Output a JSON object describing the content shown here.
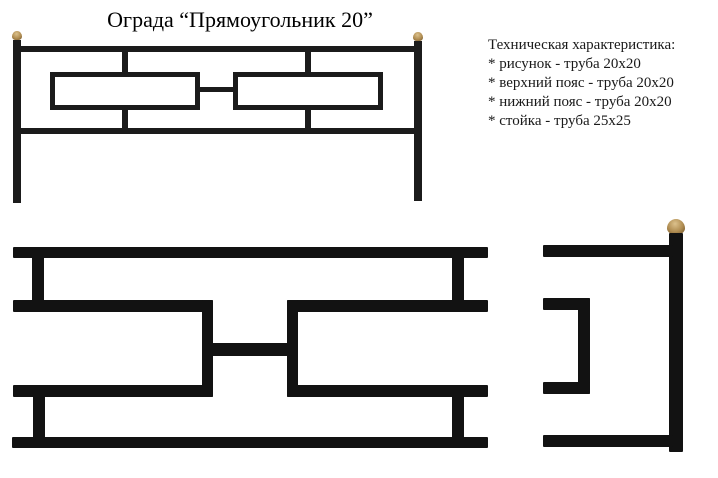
{
  "title": "Ограда “Прямоугольник 20”",
  "specs": {
    "heading": "Техническая характеристика:",
    "items": [
      "* рисунок - труба 20х20",
      "* верхний пояс - труба 20х20",
      "* нижний пояс - труба 20х20",
      "* стойка - труба 25х25"
    ]
  },
  "colors": {
    "background": "#ffffff",
    "text": "#1a1a1a",
    "metal-drawing": "#1b1b1b",
    "metal-photo": "#121212",
    "gold": "#b08d52",
    "gold-light": "#dcc18c",
    "gold-dark": "#6e5228"
  }
}
